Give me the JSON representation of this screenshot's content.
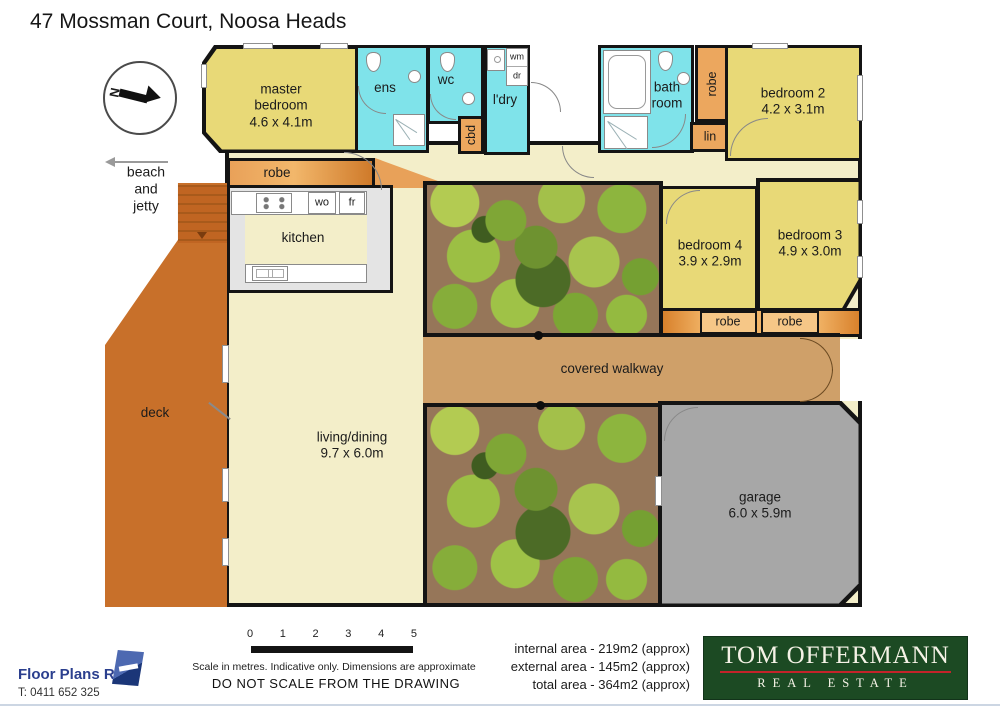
{
  "page": {
    "title": "47 Mossman Court, Noosa Heads"
  },
  "compass": {
    "north_label": "N"
  },
  "direction": {
    "line1": "beach",
    "line2": "and",
    "line3": "jetty"
  },
  "rooms": {
    "master": {
      "line1": "master",
      "line2": "bedroom",
      "dims": "4.6 x 4.1m"
    },
    "ens": {
      "label": "ens"
    },
    "wc": {
      "label": "wc"
    },
    "laundry": {
      "label": "l'dry",
      "wm": "wm",
      "dr": "dr"
    },
    "cbd": {
      "label": "cbd"
    },
    "bath": {
      "line1": "bath",
      "line2": "room"
    },
    "robe_label": "robe",
    "lin_label": "lin",
    "bedroom2": {
      "name": "bedroom 2",
      "dims": "4.2 x 3.1m"
    },
    "bedroom3": {
      "name": "bedroom 3",
      "dims": "4.9 x 3.0m"
    },
    "bedroom4": {
      "name": "bedroom 4",
      "dims": "3.9 x 2.9m"
    },
    "kitchen": {
      "label": "kitchen",
      "wo": "wo",
      "fr": "fr"
    },
    "living": {
      "name": "living/dining",
      "dims": "9.7 x 6.0m"
    },
    "deck": {
      "label": "deck"
    },
    "walkway": {
      "label": "covered walkway"
    },
    "garage": {
      "name": "garage",
      "dims": "6.0 x 5.9m"
    }
  },
  "footer": {
    "scale": {
      "ticks": [
        "0",
        "1",
        "2",
        "3",
        "4",
        "5"
      ],
      "note1": "Scale in metres. Indicative only. Dimensions are approximate",
      "note2": "DO NOT SCALE FROM THE DRAWING"
    },
    "areas": {
      "internal": "internal area - 219m2 (approx)",
      "external": "external area - 145m2 (approx)",
      "total": "total area - 364m2 (approx)"
    },
    "provider": {
      "name": "Floor Plans R Us",
      "phone": "T: 0411 652 325"
    },
    "agency": {
      "name": "TOM OFFERMANN",
      "tagline": "REAL ESTATE"
    }
  },
  "colors": {
    "agency_green": "#1c4a23",
    "agency_red": "#c4232a",
    "provider_blue": "#2b3f8e"
  }
}
